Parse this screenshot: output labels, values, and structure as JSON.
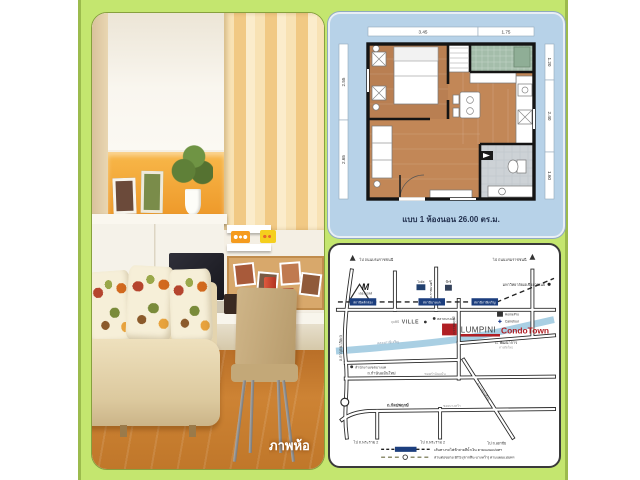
{
  "photo": {
    "caption": "ภาพห้อ"
  },
  "floorplan": {
    "dims_top": [
      "3.45",
      "1.75"
    ],
    "dims_left": [
      "2.55",
      "2.65"
    ],
    "dims_right": [
      "1.20",
      "2.40",
      "1.60"
    ],
    "caption": "แบบ 1 ห้องนอน 26.00 ตร.ม."
  },
  "map": {
    "logo": {
      "name": "LUMPINI",
      "type": "CondoTown"
    },
    "arrows": {
      "top_left": "ไป ถนนบรมราชชนนี",
      "top_right": "ไป ถนนบรมราชชนนี"
    },
    "stations": [
      "สถานีหลักสอง",
      "สถานีบางแค",
      "สถานีภาษีเจริญ"
    ],
    "landmarks": {
      "the_mall": "M",
      "the_mall_label": "เดอะมอลล์",
      "lotus": "โลตัส",
      "bigc": "บิ๊กซี",
      "university": "มหาวิทยาลัยเอเชียอาคเนย์",
      "ville_prefix": "ลุมพินี",
      "ville": "VILLE",
      "market": "ตลาดบางแค",
      "homepro": "HomePro",
      "carrefour": "Carrefour",
      "district_office": "สำนักงานเขตบางแค"
    },
    "roads": {
      "kanchanaphisek": "ถ.กาญจนาภิเษก",
      "ratchamontri": "ถ.ราชมนตรี",
      "ratchaphruek": "ถ.ราชพฤกษ์",
      "phatthanakan": "ถ. พัฒนาการ",
      "phatthanakan_sub": "ทางตัดใหม่",
      "canal": "คลองภาษีเจริญ",
      "kamnanmaen": "ถ.กำนันแม้นใหม่",
      "kamnanmaen_sub": "ซอยกำนันแม้น",
      "bangkhuntian": "ถ.บางขุนเทียน",
      "kanlapaphruek": "ถ.กัลปพฤกษ์",
      "kanlapaphruek_sub": "ซอยบางหว้า",
      "to_rama2_left": "ไป ถ.พระราม 2",
      "to_rama2_mid": "ไป ถ.พระราม 2",
      "to_ekkachai": "ไป ถ.เอกชัย"
    },
    "legend": [
      {
        "label": "เส้นทางรถไฟฟ้าสายสีน้ำเงิน ตามแผนแม่บทฯ"
      },
      {
        "label": "ส่วนต่อขยาย BTS (ตากสิน-บางหว้า) ตามแผนแม่บทฯ"
      }
    ],
    "colors": {
      "station_box": "#1c3e7e",
      "logo_red": "#b01f24",
      "canal_blue": "#a9cfe3",
      "frame_green": "#c4e66f"
    }
  }
}
